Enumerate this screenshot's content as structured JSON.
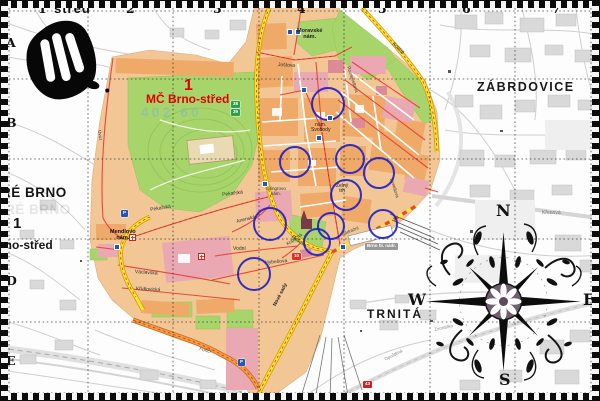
{
  "map_meta": {
    "sheet_title": "střed",
    "callout": {
      "number": "1",
      "label": "MČ Brno-střed"
    },
    "watermark": "402 60"
  },
  "grid": {
    "columns": [
      {
        "label": "1",
        "x": 38
      },
      {
        "label": "2",
        "x": 126
      },
      {
        "label": "3",
        "x": 213
      },
      {
        "label": "4",
        "x": 297
      },
      {
        "label": "5",
        "x": 378
      },
      {
        "label": "6",
        "x": 462
      },
      {
        "label": "7",
        "x": 552
      }
    ],
    "rows": [
      {
        "label": "A",
        "y": 37
      },
      {
        "label": "B",
        "y": 117
      },
      {
        "label": "D",
        "y": 275
      },
      {
        "label": "E",
        "y": 355
      }
    ]
  },
  "labels": [
    {
      "name": "sheet-title",
      "text": "střed",
      "x": 54,
      "y": 2,
      "size": 13,
      "bold": true,
      "ls": 1,
      "color": "#111111"
    },
    {
      "name": "district-label-zabrdovice",
      "text": "ZÁBRDOVICE",
      "x": 477,
      "y": 81,
      "size": 12.5,
      "bold": true,
      "ls": 1.5,
      "color": "#191919"
    },
    {
      "name": "district-label-trnita",
      "text": "TRNITÁ",
      "x": 367,
      "y": 308,
      "size": 12,
      "bold": true,
      "ls": 2,
      "color": "#191919"
    },
    {
      "name": "district-label-stare-brno",
      "text": "RÉ BRNO",
      "x": 1,
      "y": 186,
      "size": 13.5,
      "bold": true,
      "ls": 0.5,
      "color": "#141414"
    },
    {
      "name": "district-label-stare-brno-ghost",
      "text": "RÉ BRNO",
      "x": 5,
      "y": 203,
      "size": 13.5,
      "bold": true,
      "ls": 0.5,
      "color": "rgba(20,20,20,0.10)"
    },
    {
      "name": "district-number-stare-brno",
      "text": "1",
      "x": 13,
      "y": 216,
      "size": 15,
      "bold": true,
      "color": "#141414"
    },
    {
      "name": "district-label-brno-stred-edge",
      "text": "rno-střed",
      "x": 0,
      "y": 239,
      "size": 12,
      "bold": true,
      "color": "#141414"
    },
    {
      "name": "callout-district-number",
      "text": "1",
      "x": 184,
      "y": 77,
      "size": 16,
      "bold": true,
      "color": "#e00000"
    },
    {
      "name": "callout-district-name",
      "text": "MČ Brno-střed",
      "x": 146,
      "y": 93,
      "size": 12,
      "bold": true,
      "color": "#e00000"
    },
    {
      "name": "map-code-watermark",
      "text": "402 60",
      "x": 141,
      "y": 105,
      "size": 14,
      "bold": true,
      "ls": 3,
      "color": "rgba(120,175,215,0.45)"
    },
    {
      "name": "place-label-moravske-namesti",
      "text": "Moravské\nnám.",
      "x": 297,
      "y": 29,
      "size": 5.5,
      "bold": true,
      "pre": true,
      "color": "#222222"
    },
    {
      "name": "place-label-namesti-svobody",
      "text": "nám.\nSvobody",
      "x": 311,
      "y": 123,
      "size": 5,
      "pre": true,
      "color": "#222222"
    },
    {
      "name": "place-label-zelny-trh",
      "text": "Zelný\ntrh",
      "x": 336,
      "y": 184,
      "size": 5,
      "pre": true,
      "color": "#222222"
    },
    {
      "name": "place-label-silingrovo-namesti",
      "text": "Šilingrovo\nnám.",
      "x": 266,
      "y": 187,
      "size": 4.5,
      "pre": true,
      "color": "#333333"
    },
    {
      "name": "place-label-mendlovo-namesti",
      "text": "Mendlovo\nnám.",
      "x": 110,
      "y": 230,
      "size": 5.5,
      "bold": true,
      "pre": true,
      "color": "#111111"
    },
    {
      "name": "street-label-pekarska-west",
      "text": "Pekařská",
      "x": 150,
      "y": 208,
      "size": 5,
      "rot": -9,
      "color": "#333333"
    },
    {
      "name": "street-label-pekarska-east",
      "text": "Pekařská",
      "x": 222,
      "y": 193,
      "size": 5,
      "rot": -7,
      "color": "#333333"
    },
    {
      "name": "street-label-anenska",
      "text": "Anenská",
      "x": 236,
      "y": 220,
      "size": 5,
      "rot": -14,
      "color": "#333333"
    },
    {
      "name": "street-label-husova",
      "text": "Husova",
      "x": 293,
      "y": 235,
      "size": 5,
      "rot": 35,
      "color": "#333333"
    },
    {
      "name": "street-label-vodni",
      "text": "Vodní",
      "x": 233,
      "y": 247,
      "size": 5,
      "color": "#333333"
    },
    {
      "name": "street-label-hybesova",
      "text": "Hybešova",
      "x": 265,
      "y": 261,
      "size": 5,
      "rot": -5,
      "color": "#333333"
    },
    {
      "name": "street-label-vaclavska",
      "text": "Václavská",
      "x": 135,
      "y": 270,
      "size": 5,
      "rot": 4,
      "color": "#333333"
    },
    {
      "name": "street-label-kridlovicka",
      "text": "Křídlovická",
      "x": 136,
      "y": 287,
      "size": 5,
      "rot": 3,
      "color": "#333333"
    },
    {
      "name": "street-label-kopecna",
      "text": "Kopečná",
      "x": 286,
      "y": 243,
      "size": 4.5,
      "rot": -35,
      "color": "#333333"
    },
    {
      "name": "street-label-nove-sady",
      "text": "Nové sady",
      "x": 273,
      "y": 305,
      "size": 5,
      "rot": -63,
      "bold": true,
      "color": "#222222"
    },
    {
      "name": "street-label-jostova",
      "text": "Joštova",
      "x": 278,
      "y": 63,
      "size": 5,
      "rot": 3,
      "color": "#333333"
    },
    {
      "name": "street-label-koliste",
      "text": "Koliště",
      "x": 394,
      "y": 42,
      "size": 5,
      "rot": 44,
      "color": "#333333"
    },
    {
      "name": "street-label-rooseveltova",
      "text": "Rooseveltova",
      "x": 350,
      "y": 66,
      "size": 4.5,
      "rot": 72,
      "color": "#333333"
    },
    {
      "name": "street-label-benesova",
      "text": "Benešova",
      "x": 393,
      "y": 178,
      "size": 4.5,
      "rot": 72,
      "color": "#333333"
    },
    {
      "name": "street-label-nadrazni",
      "text": "Nádražní",
      "x": 341,
      "y": 233,
      "size": 4.5,
      "rot": -22,
      "color": "#444444"
    },
    {
      "name": "street-label-krenova",
      "text": "Křenová",
      "x": 542,
      "y": 211,
      "size": 5,
      "color": "#777777"
    },
    {
      "name": "street-label-opustena",
      "text": "Opuštěná",
      "x": 384,
      "y": 358,
      "size": 4.5,
      "rot": -27,
      "color": "#888888"
    },
    {
      "name": "street-label-zvonarka",
      "text": "Zvonařka",
      "x": 434,
      "y": 328,
      "size": 4.5,
      "rot": -12,
      "color": "#888888"
    },
    {
      "name": "street-label-uvoz",
      "text": "Úvoz",
      "x": 101,
      "y": 130,
      "size": 4.5,
      "rot": 82,
      "color": "#444444"
    },
    {
      "name": "street-label-porici",
      "text": "Poříčí",
      "x": 200,
      "y": 347,
      "size": 4.5,
      "rot": 16,
      "color": "#5a3a10"
    },
    {
      "name": "compass-letter-n",
      "text": "N",
      "x": 496,
      "y": 202,
      "size": 16,
      "serif": true,
      "bold": true,
      "color": "#111111"
    },
    {
      "name": "compass-letter-s",
      "text": "S",
      "x": 499,
      "y": 371,
      "size": 16,
      "serif": true,
      "bold": true,
      "color": "#111111"
    },
    {
      "name": "compass-letter-w",
      "text": "W",
      "x": 408,
      "y": 291,
      "size": 16,
      "serif": true,
      "bold": true,
      "color": "#111111"
    },
    {
      "name": "compass-letter-e",
      "text": "E",
      "x": 583,
      "y": 291,
      "size": 16,
      "serif": true,
      "bold": true,
      "color": "#111111"
    }
  ],
  "badges": [
    {
      "name": "road-number-badge-10",
      "text": "10",
      "x": 292,
      "y": 253,
      "bg": "#e03020",
      "fg": "#ffffff"
    },
    {
      "name": "road-number-badge-43",
      "text": "43",
      "x": 363,
      "y": 381,
      "bg": "#cc2222",
      "fg": "#ffffff"
    },
    {
      "name": "transit-route-badge-38",
      "text": "38",
      "x": 231,
      "y": 101,
      "bg": "#2e9e4f",
      "fg": "#ffffff"
    },
    {
      "name": "transit-route-badge-39",
      "text": "39",
      "x": 231,
      "y": 109,
      "bg": "#2e9e4f",
      "fg": "#ffffff"
    },
    {
      "name": "station-name-badge",
      "text": "Brno hl. nádr.",
      "x": 365,
      "y": 243,
      "bg": "#98989a",
      "fg": "#ffffff"
    },
    {
      "name": "parking-badge-pekarska",
      "text": "P",
      "x": 121,
      "y": 210,
      "bg": "#2456b8",
      "fg": "#ffffff"
    },
    {
      "name": "parking-badge-nove-sady",
      "text": "P",
      "x": 238,
      "y": 359,
      "bg": "#2456b8",
      "fg": "#ffffff"
    }
  ],
  "icons": [
    {
      "type": "tram-stop-icon",
      "x": 288,
      "y": 30
    },
    {
      "type": "tram-stop-icon",
      "x": 296,
      "y": 30
    },
    {
      "type": "tram-stop-icon",
      "x": 317,
      "y": 136
    },
    {
      "type": "tram-stop-icon",
      "x": 341,
      "y": 245
    },
    {
      "type": "tram-stop-icon",
      "x": 263,
      "y": 182
    },
    {
      "type": "tram-stop-icon",
      "x": 115,
      "y": 245
    },
    {
      "type": "tram-stop-icon",
      "x": 302,
      "y": 88
    },
    {
      "type": "tram-stop-icon",
      "x": 328,
      "y": 116
    },
    {
      "type": "hospital-cross-icon",
      "x": 199,
      "y": 254
    },
    {
      "type": "hospital-cross-icon",
      "x": 130,
      "y": 235
    }
  ],
  "circles": [
    {
      "x": 326,
      "y": 102,
      "r": 15
    },
    {
      "x": 293,
      "y": 160,
      "r": 14
    },
    {
      "x": 348,
      "y": 157,
      "r": 13
    },
    {
      "x": 377,
      "y": 171,
      "r": 14
    },
    {
      "x": 344,
      "y": 193,
      "r": 14
    },
    {
      "x": 268,
      "y": 222,
      "r": 15
    },
    {
      "x": 329,
      "y": 224,
      "r": 12
    },
    {
      "x": 315,
      "y": 240,
      "r": 12
    },
    {
      "x": 381,
      "y": 222,
      "r": 13
    },
    {
      "x": 252,
      "y": 272,
      "r": 15
    }
  ],
  "colors": {
    "district_base": "#f2c695",
    "park_green": "#a8d56b",
    "block_orange": "#efa968",
    "block_pink": "#e9a8b2",
    "block_red": "#db8a96",
    "road_yellow": "#ffe133",
    "road_orange": "#f59b42",
    "road_red": "#e8483c",
    "circle_blue": "#1818c8",
    "callout_red": "#e00000"
  }
}
